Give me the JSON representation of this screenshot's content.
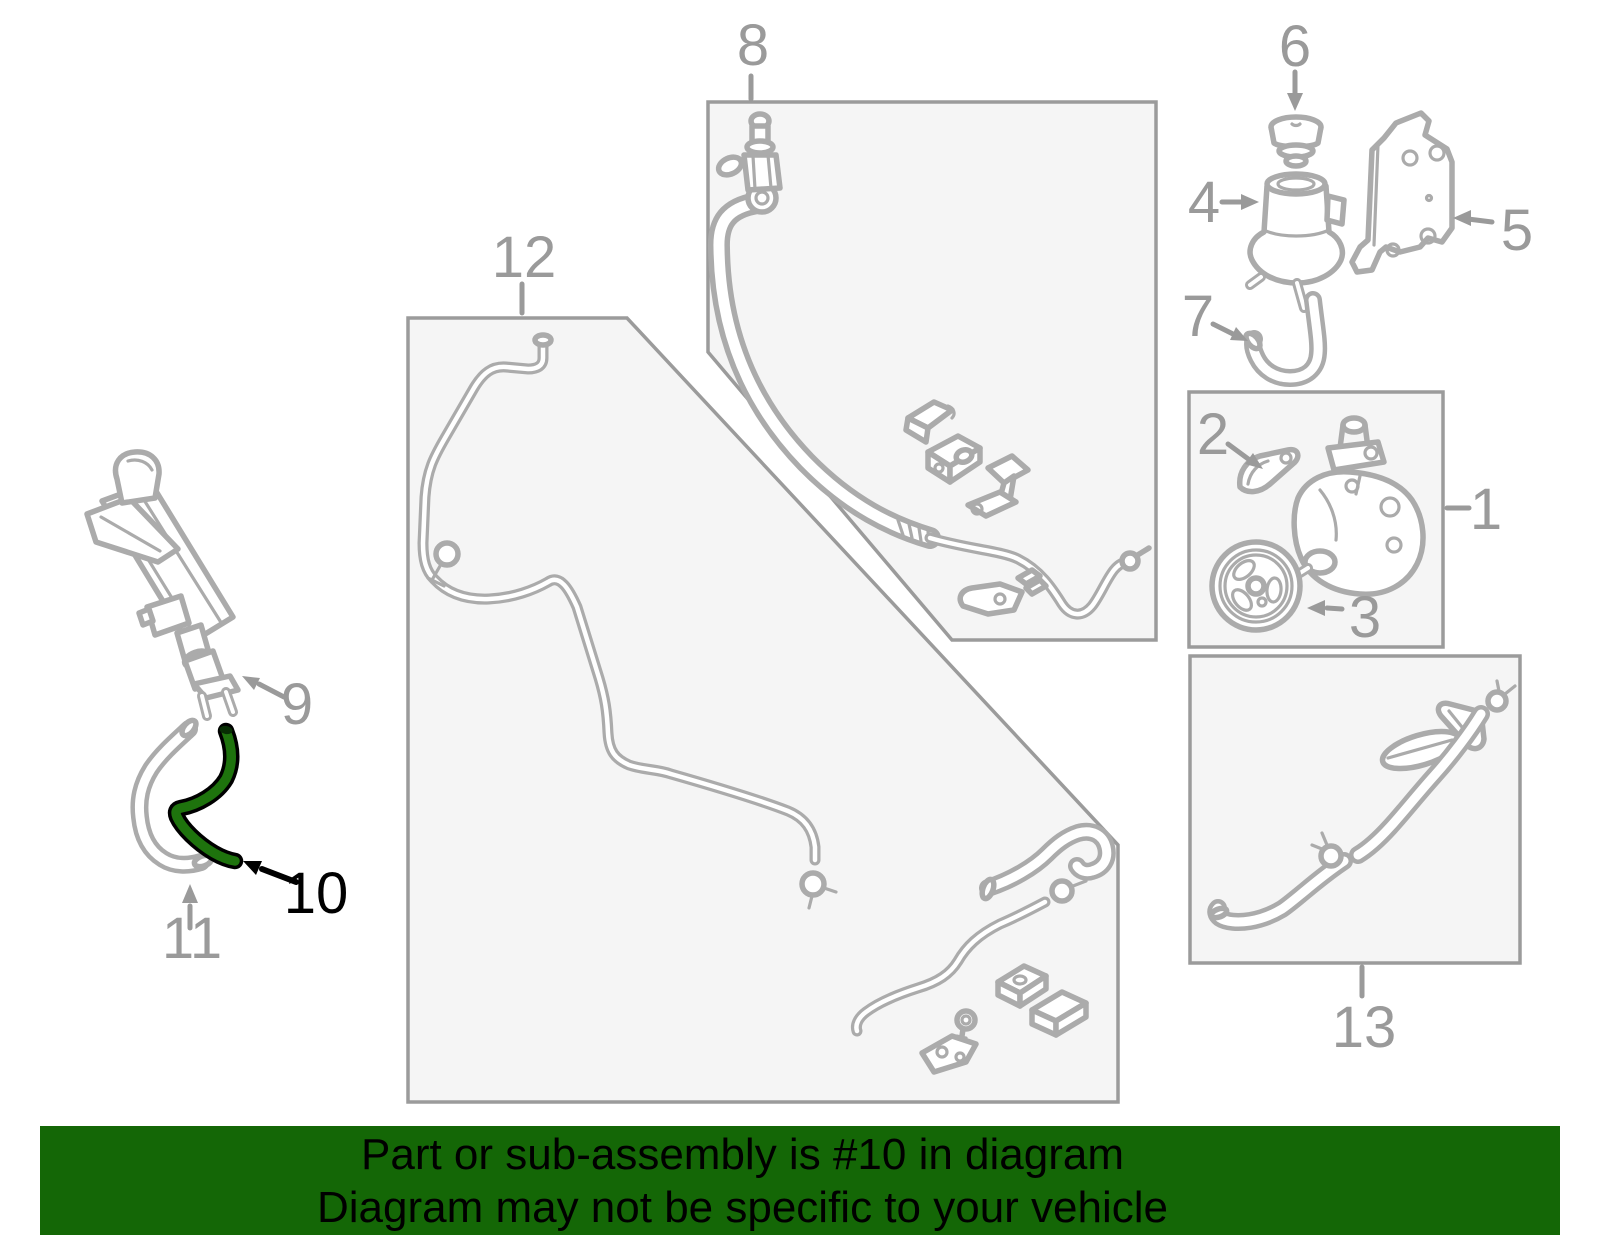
{
  "banner": {
    "line1": "Part or sub-assembly is #10 in diagram",
    "line2": "Diagram may not be specific to your vehicle"
  },
  "highlight": {
    "callout_number": "10"
  },
  "colors": {
    "background": "#ffffff",
    "line_art_gray": "#ababab",
    "label_gray": "#9a9a9a",
    "box_fill": "#f5f5f5",
    "box_border": "#9b9b9b",
    "highlight_green": "#1e730d",
    "highlight_outline": "#000000",
    "banner_bg": "#146706",
    "banner_text": "#000000"
  },
  "callouts": [
    {
      "label": "1",
      "color": "gray",
      "pointer": "dash"
    },
    {
      "label": "2",
      "color": "gray",
      "pointer": "arrow"
    },
    {
      "label": "3",
      "color": "gray",
      "pointer": "arrow"
    },
    {
      "label": "4",
      "color": "gray",
      "pointer": "arrow"
    },
    {
      "label": "5",
      "color": "gray",
      "pointer": "arrow"
    },
    {
      "label": "6",
      "color": "gray",
      "pointer": "arrow"
    },
    {
      "label": "7",
      "color": "gray",
      "pointer": "arrow"
    },
    {
      "label": "8",
      "color": "gray",
      "pointer": "line"
    },
    {
      "label": "9",
      "color": "gray",
      "pointer": "arrow"
    },
    {
      "label": "10",
      "color": "black",
      "pointer": "arrow",
      "highlighted": true
    },
    {
      "label": "11",
      "color": "gray",
      "pointer": "arrow"
    },
    {
      "label": "12",
      "color": "gray",
      "pointer": "line"
    },
    {
      "label": "13",
      "color": "gray",
      "pointer": "line"
    }
  ]
}
